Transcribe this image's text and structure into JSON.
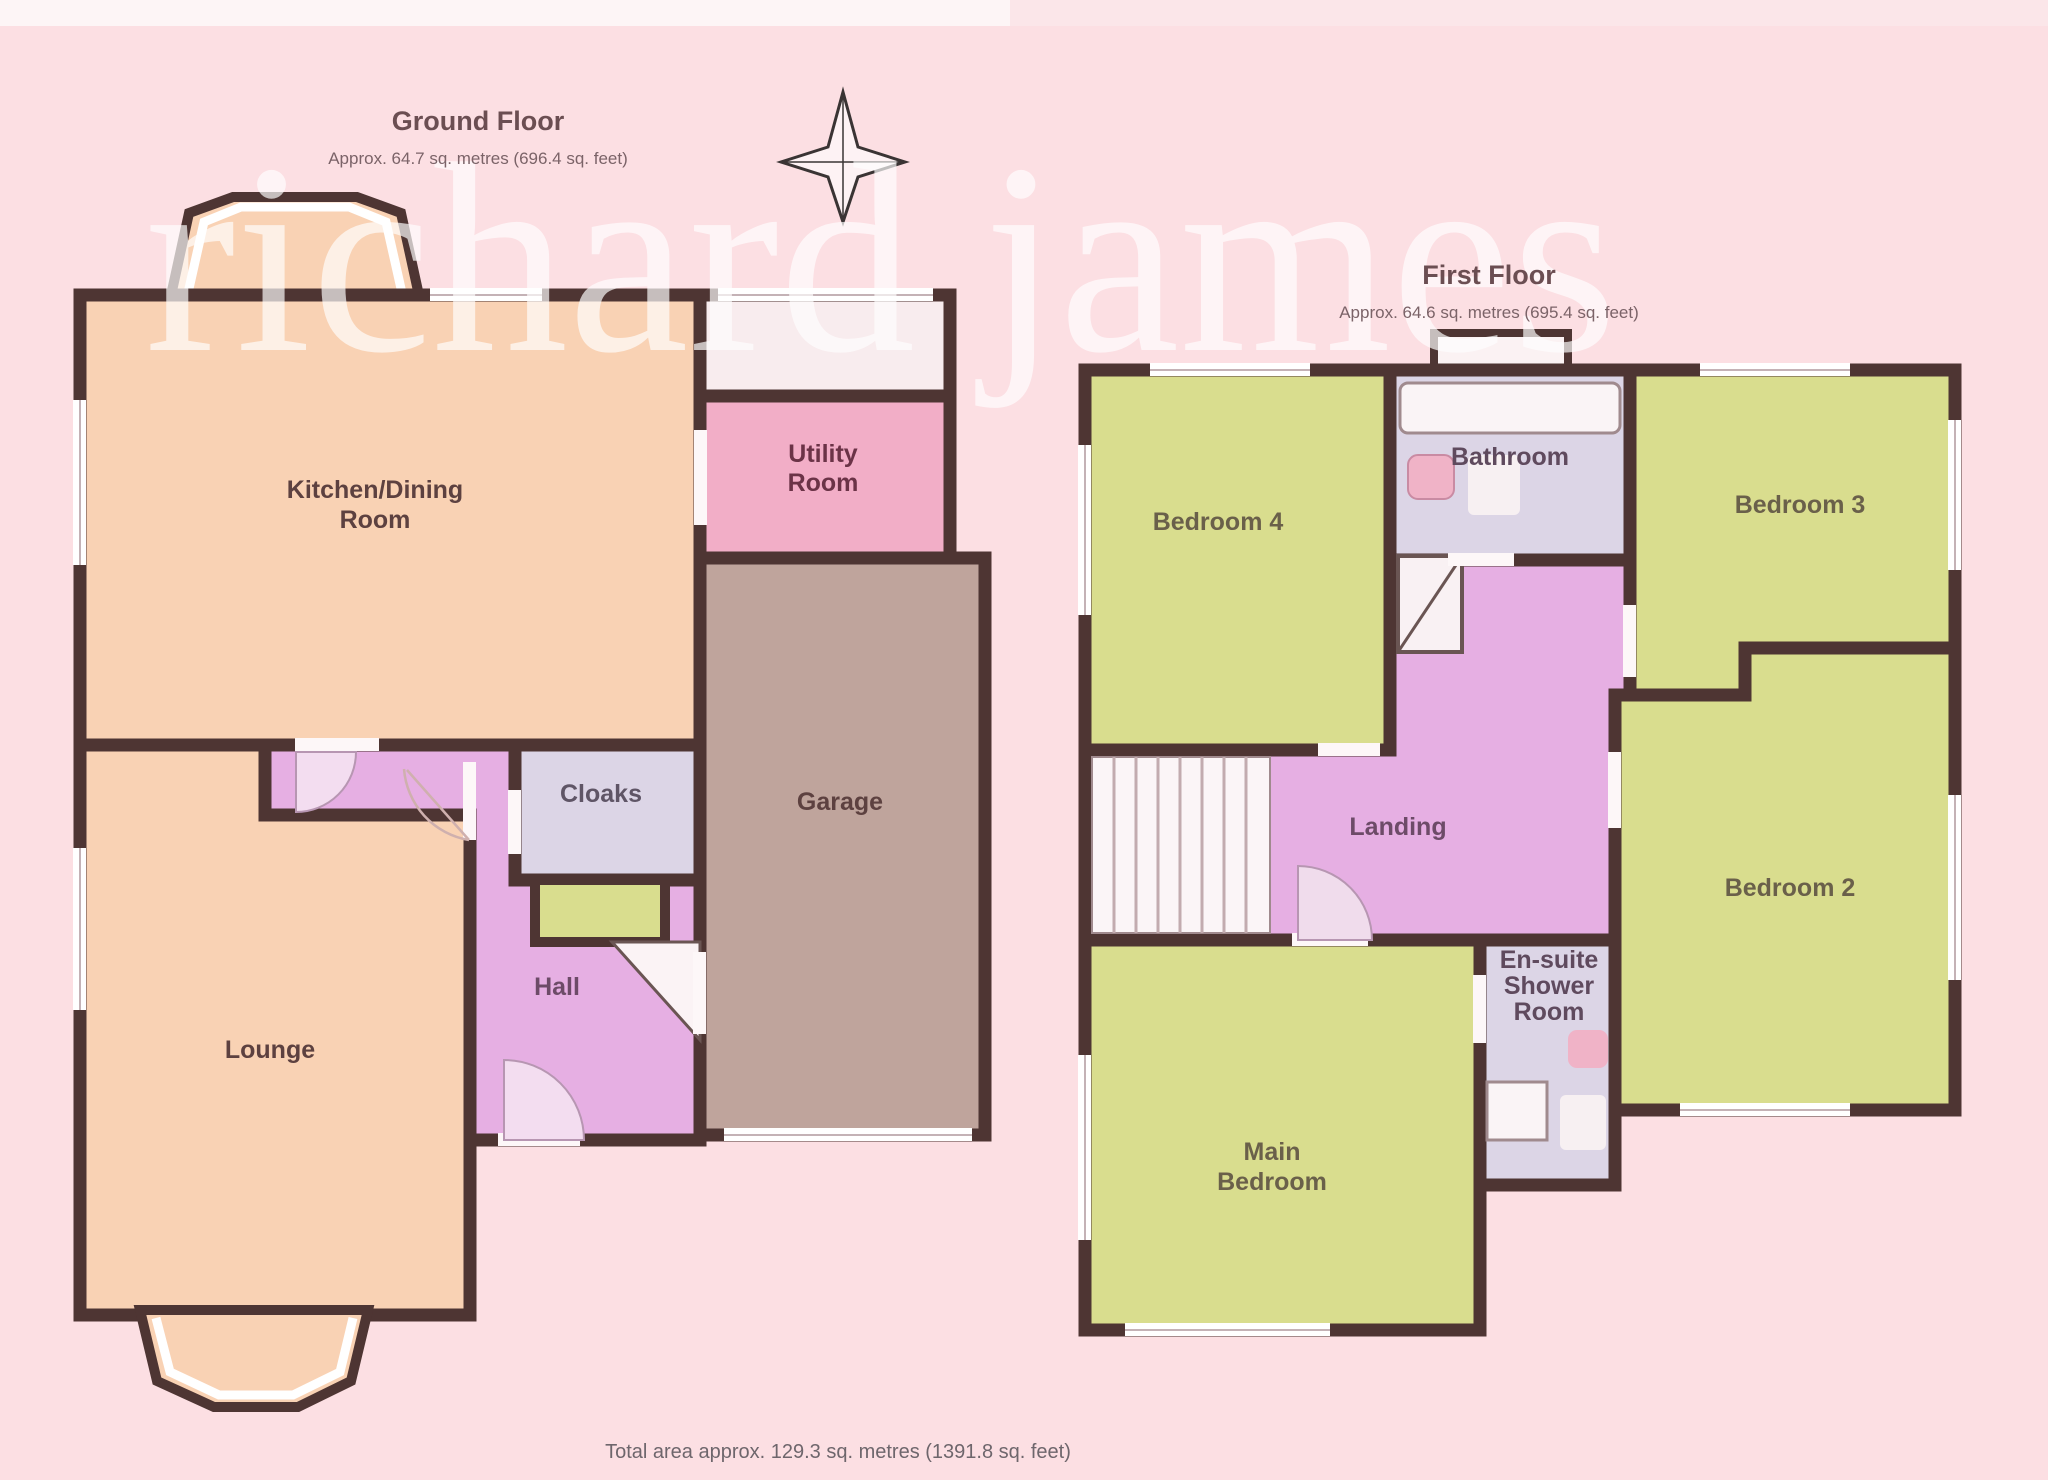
{
  "watermark": "richard james",
  "footer": "Total area approx. 129.3 sq. metres (1391.8 sq. feet)",
  "ground_floor": {
    "title": "Ground Floor",
    "area_note": "Approx. 64.7 sq. metres (696.4 sq. feet)",
    "rooms": {
      "kitchen_line1": "Kitchen/Dining",
      "kitchen_line2": "Room",
      "utility_line1": "Utility",
      "utility_line2": "Room",
      "garage": "Garage",
      "hall": "Hall",
      "cloaks": "Cloaks",
      "lounge": "Lounge"
    }
  },
  "first_floor": {
    "title": "First Floor",
    "area_note": "Approx. 64.6 sq. metres (695.4 sq. feet)",
    "rooms": {
      "bedroom4": "Bedroom 4",
      "bedroom3": "Bedroom 3",
      "bedroom2": "Bedroom 2",
      "main_bedroom_line1": "Main",
      "main_bedroom_line2": "Bedroom",
      "landing": "Landing",
      "bathroom": "Bathroom",
      "ensuite_line1": "En-suite",
      "ensuite_line2": "Shower",
      "ensuite_line3": "Room"
    }
  },
  "colors": {
    "background": "#fcdfe3",
    "wall": "#4e3533",
    "room_peach": "#f9d2b4",
    "room_pink": "#f2aec7",
    "room_taupe": "#bfa49c",
    "room_orchid": "#e6afe3",
    "room_lavender": "#dcd5e6",
    "room_green": "#d9dd8e",
    "watermark_white": "#ffffff"
  }
}
